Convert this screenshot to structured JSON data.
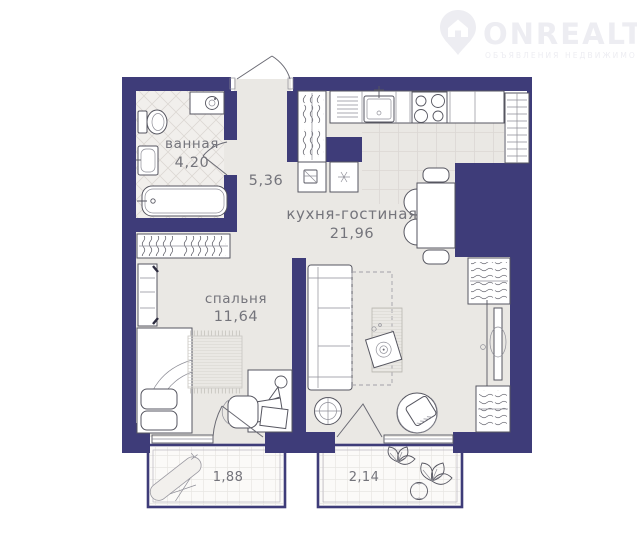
{
  "watermark": {
    "brand": "ONREALT",
    "tagline": "ОБЪЯВЛЕНИЯ НЕДВИЖИМОСТИ"
  },
  "rooms": {
    "bathroom": {
      "label": "ванная",
      "area": "4,20"
    },
    "hallway": {
      "area": "5,36"
    },
    "kitchen_living": {
      "label": "кухня-гостиная",
      "area": "21,96"
    },
    "bedroom": {
      "label": "спальня",
      "area": "11,64"
    },
    "balcony_left": {
      "area": "1,88"
    },
    "balcony_right": {
      "area": "2,14"
    }
  },
  "colors": {
    "wall": "#3e3c79",
    "floor": "#eae8e4",
    "bathroom_floor": "#f1efec",
    "label_text": "#74747b",
    "watermark": "#ededf2",
    "background": "#ffffff"
  }
}
